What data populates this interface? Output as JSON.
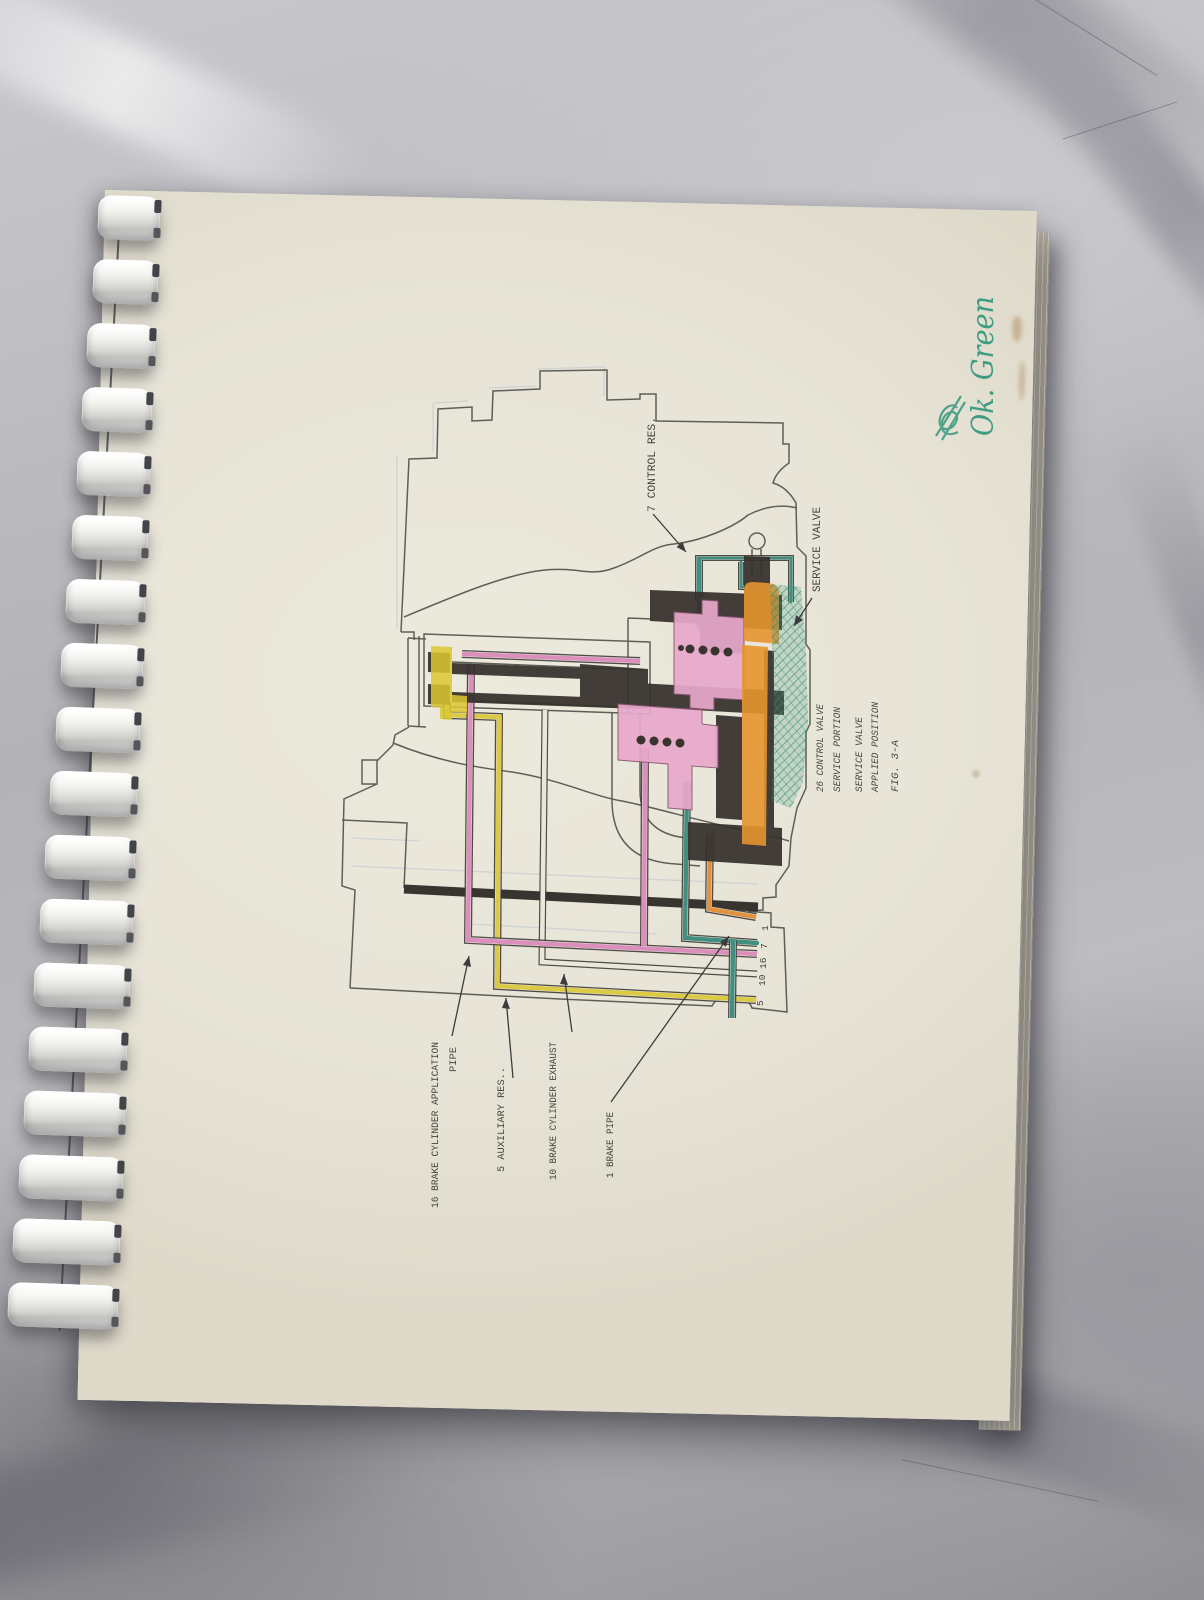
{
  "annotations": {
    "handwriting": "Ok. Green"
  },
  "figure": {
    "callouts": {
      "control_res": "7 CONTROL RES.",
      "service_valve": "SERVICE VALVE",
      "brake_cyl_application_line1": "16 BRAKE CYLINDER APPLICATION",
      "brake_cyl_application_line2": "PIPE",
      "auxiliary_res": "5 AUXILIARY RES..",
      "brake_cyl_exhaust": "10 BRAKE CYLINDER EXHAUST",
      "brake_pipe": "1 BRAKE PIPE"
    },
    "caption": [
      "26 CONTROL VALVE",
      "SERVICE PORTION",
      "SERVICE VALVE",
      "APPLIED POSITION",
      "FIG. 3-A"
    ],
    "pipe_numbers": [
      "1",
      "7",
      "16",
      "10",
      "5"
    ],
    "colors": {
      "pink_pipe": "#d783b8",
      "yellow_pipe": "#d9c62f",
      "teal_pipe": "#2e8577",
      "orange_pipe": "#e0882e",
      "green_hatch": "#2f8e74",
      "green_ink": "#3f9c82"
    }
  }
}
